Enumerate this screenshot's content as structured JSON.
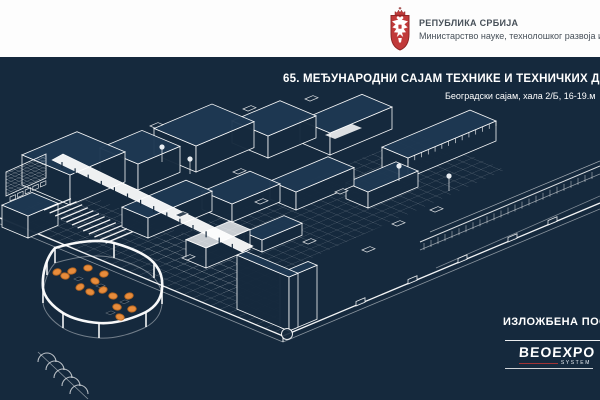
{
  "slide": {
    "header": {
      "coat_of_arms_icon": "serbia-coat-of-arms-icon",
      "line1": "РЕПУБЛИКА СРБИЈА",
      "line2": "Министарство науке, технолошког развоја и ин"
    },
    "title": "65. МЕЂУНАРОДНИ САЈАМ ТЕХНИКЕ И ТЕХНИЧКИХ ДОСТИГ",
    "subtitle": "Београдски сајам, хала 2/Б, 16-19.м",
    "footer": {
      "label": "ИЗЛОЖБЕНА ПОСТ",
      "brand": "BEOEXPO",
      "brand_sub": "SYSTEM"
    },
    "drawing": {
      "subject": "isometric-wireframe-floor-plan-of-exhibition-hall",
      "furniture_marker_count": 14
    }
  },
  "colors": {
    "background": "#15293d",
    "line": "#ffffff",
    "header_bg": "#fdfdfd",
    "header_text": "#475059",
    "title_text": "#ffffff",
    "accent_orange": "#e78c3c",
    "accent_orange_dark": "#b4641f",
    "shield_red": "#c13a3a",
    "brand_red": "#b03434"
  }
}
